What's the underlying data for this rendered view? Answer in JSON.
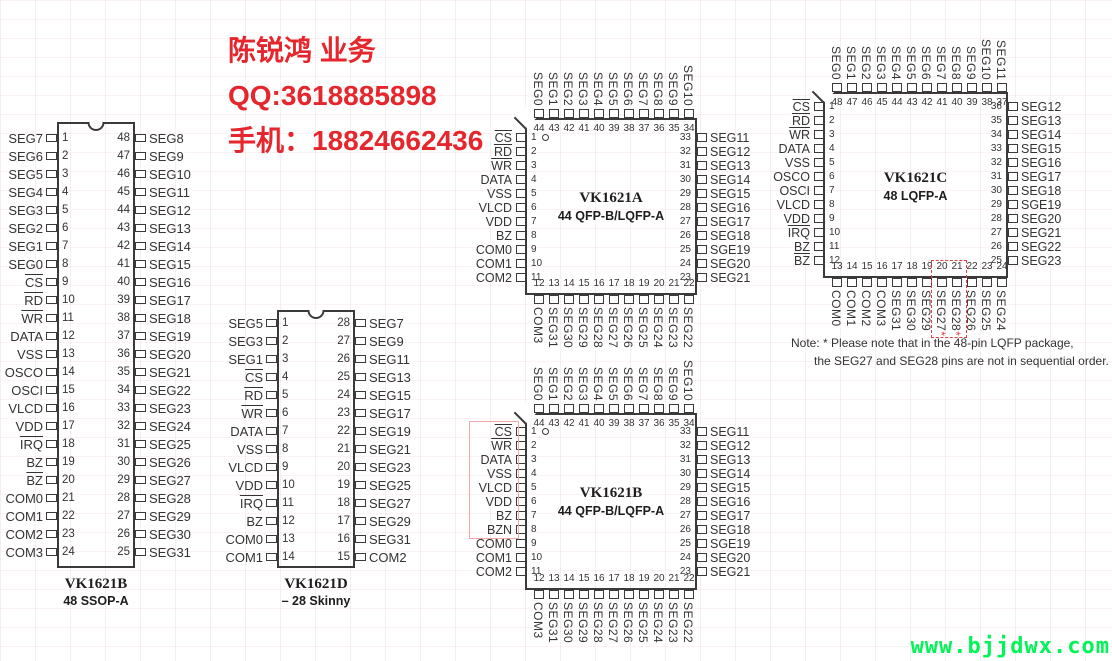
{
  "colors": {
    "accent_red": "#e5262c",
    "watermark_green": "#00f455",
    "highlight_pink": "#f0a8a8",
    "highlight_red": "#e04040"
  },
  "contact": {
    "lines": [
      "陈锐鸿 业务",
      "QQ:3618885898",
      "手机：18824662436"
    ]
  },
  "note": {
    "line1": "Note: * Please note that in the 48-pin LQFP package,",
    "line2": "the SEG27 and SEG28 pins are not in sequential order."
  },
  "watermark": "www.bjjdwx.com",
  "chips": [
    {
      "id": "dip48",
      "package": "dip",
      "title": "VK1621B",
      "subtitle": "48 SSOP-A",
      "left": [
        {
          "n": 1,
          "t": "SEG7"
        },
        {
          "n": 2,
          "t": "SEG6"
        },
        {
          "n": 3,
          "t": "SEG5"
        },
        {
          "n": 4,
          "t": "SEG4"
        },
        {
          "n": 5,
          "t": "SEG3"
        },
        {
          "n": 6,
          "t": "SEG2"
        },
        {
          "n": 7,
          "t": "SEG1"
        },
        {
          "n": 8,
          "t": "SEG0"
        },
        {
          "n": 9,
          "t": "CS",
          "bar": true
        },
        {
          "n": 10,
          "t": "RD",
          "bar": true
        },
        {
          "n": 11,
          "t": "WR",
          "bar": true
        },
        {
          "n": 12,
          "t": "DATA"
        },
        {
          "n": 13,
          "t": "VSS"
        },
        {
          "n": 14,
          "t": "OSCO"
        },
        {
          "n": 15,
          "t": "OSCI"
        },
        {
          "n": 16,
          "t": "VLCD"
        },
        {
          "n": 17,
          "t": "VDD"
        },
        {
          "n": 18,
          "t": "IRQ",
          "bar": true
        },
        {
          "n": 19,
          "t": "BZ"
        },
        {
          "n": 20,
          "t": "BZ",
          "bar": true
        },
        {
          "n": 21,
          "t": "COM0"
        },
        {
          "n": 22,
          "t": "COM1"
        },
        {
          "n": 23,
          "t": "COM2"
        },
        {
          "n": 24,
          "t": "COM3"
        }
      ],
      "right": [
        {
          "n": 48,
          "t": "SEG8"
        },
        {
          "n": 47,
          "t": "SEG9"
        },
        {
          "n": 46,
          "t": "SEG10"
        },
        {
          "n": 45,
          "t": "SEG11"
        },
        {
          "n": 44,
          "t": "SEG12"
        },
        {
          "n": 43,
          "t": "SEG13"
        },
        {
          "n": 42,
          "t": "SEG14"
        },
        {
          "n": 41,
          "t": "SEG15"
        },
        {
          "n": 40,
          "t": "SEG16"
        },
        {
          "n": 39,
          "t": "SEG17"
        },
        {
          "n": 38,
          "t": "SEG18"
        },
        {
          "n": 37,
          "t": "SEG19"
        },
        {
          "n": 36,
          "t": "SEG20"
        },
        {
          "n": 35,
          "t": "SEG21"
        },
        {
          "n": 34,
          "t": "SEG22"
        },
        {
          "n": 33,
          "t": "SEG23"
        },
        {
          "n": 32,
          "t": "SEG24"
        },
        {
          "n": 31,
          "t": "SEG25"
        },
        {
          "n": 30,
          "t": "SEG26"
        },
        {
          "n": 29,
          "t": "SEG27"
        },
        {
          "n": 28,
          "t": "SEG28"
        },
        {
          "n": 27,
          "t": "SEG29"
        },
        {
          "n": 26,
          "t": "SEG30"
        },
        {
          "n": 25,
          "t": "SEG31"
        }
      ]
    },
    {
      "id": "dip28",
      "package": "dip",
      "title": "VK1621D",
      "subtitle": "– 28 Skinny",
      "left": [
        {
          "n": 1,
          "t": "SEG5"
        },
        {
          "n": 2,
          "t": "SEG3"
        },
        {
          "n": 3,
          "t": "SEG1"
        },
        {
          "n": 4,
          "t": "CS",
          "bar": true
        },
        {
          "n": 5,
          "t": "RD",
          "bar": true
        },
        {
          "n": 6,
          "t": "WR",
          "bar": true
        },
        {
          "n": 7,
          "t": "DATA"
        },
        {
          "n": 8,
          "t": "VSS"
        },
        {
          "n": 9,
          "t": "VLCD"
        },
        {
          "n": 10,
          "t": "VDD"
        },
        {
          "n": 11,
          "t": "IRQ",
          "bar": true
        },
        {
          "n": 12,
          "t": "BZ"
        },
        {
          "n": 13,
          "t": "COM0"
        },
        {
          "n": 14,
          "t": "COM1"
        }
      ],
      "right": [
        {
          "n": 28,
          "t": "SEG7"
        },
        {
          "n": 27,
          "t": "SEG9"
        },
        {
          "n": 26,
          "t": "SEG11"
        },
        {
          "n": 25,
          "t": "SEG13"
        },
        {
          "n": 24,
          "t": "SEG15"
        },
        {
          "n": 23,
          "t": "SEG17"
        },
        {
          "n": 22,
          "t": "SEG19"
        },
        {
          "n": 21,
          "t": "SEG21"
        },
        {
          "n": 20,
          "t": "SEG23"
        },
        {
          "n": 19,
          "t": "SEG25"
        },
        {
          "n": 18,
          "t": "SEG27"
        },
        {
          "n": 17,
          "t": "SEG29"
        },
        {
          "n": 16,
          "t": "SEG31"
        },
        {
          "n": 15,
          "t": "COM2"
        }
      ]
    },
    {
      "id": "qfpA",
      "package": "qfp",
      "title": "VK1621A",
      "subtitle": "44 QFP-B/LQFP-A",
      "top": [
        {
          "n": 44,
          "t": "SEG0"
        },
        {
          "n": 43,
          "t": "SEG1"
        },
        {
          "n": 42,
          "t": "SEG2"
        },
        {
          "n": 41,
          "t": "SEG3"
        },
        {
          "n": 40,
          "t": "SEG4"
        },
        {
          "n": 39,
          "t": "SEG5"
        },
        {
          "n": 38,
          "t": "SEG6"
        },
        {
          "n": 37,
          "t": "SEG7"
        },
        {
          "n": 36,
          "t": "SEG8"
        },
        {
          "n": 35,
          "t": "SEG9"
        },
        {
          "n": 34,
          "t": "SEG10"
        }
      ],
      "left": [
        {
          "n": 1,
          "t": "CS",
          "bar": true
        },
        {
          "n": 2,
          "t": "RD",
          "bar": true
        },
        {
          "n": 3,
          "t": "WR",
          "bar": true
        },
        {
          "n": 4,
          "t": "DATA"
        },
        {
          "n": 5,
          "t": "VSS"
        },
        {
          "n": 6,
          "t": "VLCD"
        },
        {
          "n": 7,
          "t": "VDD"
        },
        {
          "n": 8,
          "t": "BZ"
        },
        {
          "n": 9,
          "t": "COM0"
        },
        {
          "n": 10,
          "t": "COM1"
        },
        {
          "n": 11,
          "t": "COM2"
        }
      ],
      "right": [
        {
          "n": 33,
          "t": "SEG11"
        },
        {
          "n": 32,
          "t": "SEG12"
        },
        {
          "n": 31,
          "t": "SEG13"
        },
        {
          "n": 30,
          "t": "SEG14"
        },
        {
          "n": 29,
          "t": "SEG15"
        },
        {
          "n": 28,
          "t": "SEG16"
        },
        {
          "n": 27,
          "t": "SEG17"
        },
        {
          "n": 26,
          "t": "SEG18"
        },
        {
          "n": 25,
          "t": "SGE19"
        },
        {
          "n": 24,
          "t": "SEG20"
        },
        {
          "n": 23,
          "t": "SEG21"
        }
      ],
      "bottom": [
        {
          "n": 12,
          "t": "COM3"
        },
        {
          "n": 13,
          "t": "SEG31"
        },
        {
          "n": 14,
          "t": "SEG30"
        },
        {
          "n": 15,
          "t": "SEG29"
        },
        {
          "n": 16,
          "t": "SEG28"
        },
        {
          "n": 17,
          "t": "SEG27"
        },
        {
          "n": 18,
          "t": "SEG26"
        },
        {
          "n": 19,
          "t": "SEG25"
        },
        {
          "n": 20,
          "t": "SEG24"
        },
        {
          "n": 21,
          "t": "SEG23"
        },
        {
          "n": 22,
          "t": "SEG22"
        }
      ]
    },
    {
      "id": "qfpC",
      "package": "qfp",
      "title": "VK1621C",
      "subtitle": "48 LQFP-A",
      "top": [
        {
          "n": 48,
          "t": "SEG0"
        },
        {
          "n": 47,
          "t": "SEG1"
        },
        {
          "n": 46,
          "t": "SEG2"
        },
        {
          "n": 45,
          "t": "SEG3"
        },
        {
          "n": 44,
          "t": "SEG4"
        },
        {
          "n": 43,
          "t": "SEG5"
        },
        {
          "n": 42,
          "t": "SEG6"
        },
        {
          "n": 41,
          "t": "SEG7"
        },
        {
          "n": 40,
          "t": "SEG8"
        },
        {
          "n": 39,
          "t": "SEG9"
        },
        {
          "n": 38,
          "t": "SEG10"
        },
        {
          "n": 37,
          "t": "SEG11"
        }
      ],
      "left": [
        {
          "n": 1,
          "t": "CS",
          "bar": true
        },
        {
          "n": 2,
          "t": "RD",
          "bar": true
        },
        {
          "n": 3,
          "t": "WR",
          "bar": true
        },
        {
          "n": 4,
          "t": "DATA"
        },
        {
          "n": 5,
          "t": "VSS"
        },
        {
          "n": 6,
          "t": "OSCO"
        },
        {
          "n": 7,
          "t": "OSCI"
        },
        {
          "n": 8,
          "t": "VLCD"
        },
        {
          "n": 9,
          "t": "VDD"
        },
        {
          "n": 10,
          "t": "IRQ",
          "bar": true
        },
        {
          "n": 11,
          "t": "BZ"
        },
        {
          "n": 12,
          "t": "BZ",
          "bar": true
        }
      ],
      "right": [
        {
          "n": 36,
          "t": "SEG12"
        },
        {
          "n": 35,
          "t": "SEG13"
        },
        {
          "n": 34,
          "t": "SEG14"
        },
        {
          "n": 33,
          "t": "SEG15"
        },
        {
          "n": 32,
          "t": "SEG16"
        },
        {
          "n": 31,
          "t": "SEG17"
        },
        {
          "n": 30,
          "t": "SEG18"
        },
        {
          "n": 29,
          "t": "SGE19"
        },
        {
          "n": 28,
          "t": "SEG20"
        },
        {
          "n": 27,
          "t": "SEG21"
        },
        {
          "n": 26,
          "t": "SEG22"
        },
        {
          "n": 25,
          "t": "SEG23"
        }
      ],
      "bottom": [
        {
          "n": 13,
          "t": "COM0"
        },
        {
          "n": 14,
          "t": "COM1"
        },
        {
          "n": 15,
          "t": "COM2"
        },
        {
          "n": 16,
          "t": "COM3"
        },
        {
          "n": 17,
          "t": "SEG31"
        },
        {
          "n": 18,
          "t": "SEG30"
        },
        {
          "n": 19,
          "t": "SEG29"
        },
        {
          "n": 20,
          "t": "SEG27*"
        },
        {
          "n": 21,
          "t": "SEG28*"
        },
        {
          "n": 22,
          "t": "SEG26"
        },
        {
          "n": 23,
          "t": "SEG25"
        },
        {
          "n": 24,
          "t": "SEG24"
        }
      ]
    },
    {
      "id": "qfpB",
      "package": "qfp",
      "title": "VK1621B",
      "subtitle": "44 QFP-B/LQFP-A",
      "top": [
        {
          "n": 44,
          "t": "SEG0"
        },
        {
          "n": 43,
          "t": "SEG1"
        },
        {
          "n": 42,
          "t": "SEG2"
        },
        {
          "n": 41,
          "t": "SEG3"
        },
        {
          "n": 40,
          "t": "SEG4"
        },
        {
          "n": 39,
          "t": "SEG5"
        },
        {
          "n": 38,
          "t": "SEG6"
        },
        {
          "n": 37,
          "t": "SEG7"
        },
        {
          "n": 36,
          "t": "SEG8"
        },
        {
          "n": 35,
          "t": "SEG9"
        },
        {
          "n": 34,
          "t": "SEG10"
        }
      ],
      "left": [
        {
          "n": 1,
          "t": "CS",
          "bar": true
        },
        {
          "n": 2,
          "t": "WR",
          "bar": true
        },
        {
          "n": 3,
          "t": "DATA"
        },
        {
          "n": 4,
          "t": "VSS"
        },
        {
          "n": 5,
          "t": "VLCD"
        },
        {
          "n": 6,
          "t": "VDD"
        },
        {
          "n": 7,
          "t": "BZ"
        },
        {
          "n": 8,
          "t": "BZN"
        },
        {
          "n": 9,
          "t": "COM0"
        },
        {
          "n": 10,
          "t": "COM1"
        },
        {
          "n": 11,
          "t": "COM2"
        }
      ],
      "right": [
        {
          "n": 33,
          "t": "SEG11"
        },
        {
          "n": 32,
          "t": "SEG12"
        },
        {
          "n": 31,
          "t": "SEG13"
        },
        {
          "n": 30,
          "t": "SEG14"
        },
        {
          "n": 29,
          "t": "SEG15"
        },
        {
          "n": 28,
          "t": "SEG16"
        },
        {
          "n": 27,
          "t": "SEG17"
        },
        {
          "n": 26,
          "t": "SEG18"
        },
        {
          "n": 25,
          "t": "SGE19"
        },
        {
          "n": 24,
          "t": "SEG20"
        },
        {
          "n": 23,
          "t": "SEG21"
        }
      ],
      "bottom": [
        {
          "n": 12,
          "t": "COM3"
        },
        {
          "n": 13,
          "t": "SEG31"
        },
        {
          "n": 14,
          "t": "SEG30"
        },
        {
          "n": 15,
          "t": "SEG29"
        },
        {
          "n": 16,
          "t": "SEG28"
        },
        {
          "n": 17,
          "t": "SEG27"
        },
        {
          "n": 18,
          "t": "SEG26"
        },
        {
          "n": 19,
          "t": "SEG25"
        },
        {
          "n": 20,
          "t": "SEG24"
        },
        {
          "n": 21,
          "t": "SEG23"
        },
        {
          "n": 22,
          "t": "SEG22"
        }
      ]
    }
  ]
}
